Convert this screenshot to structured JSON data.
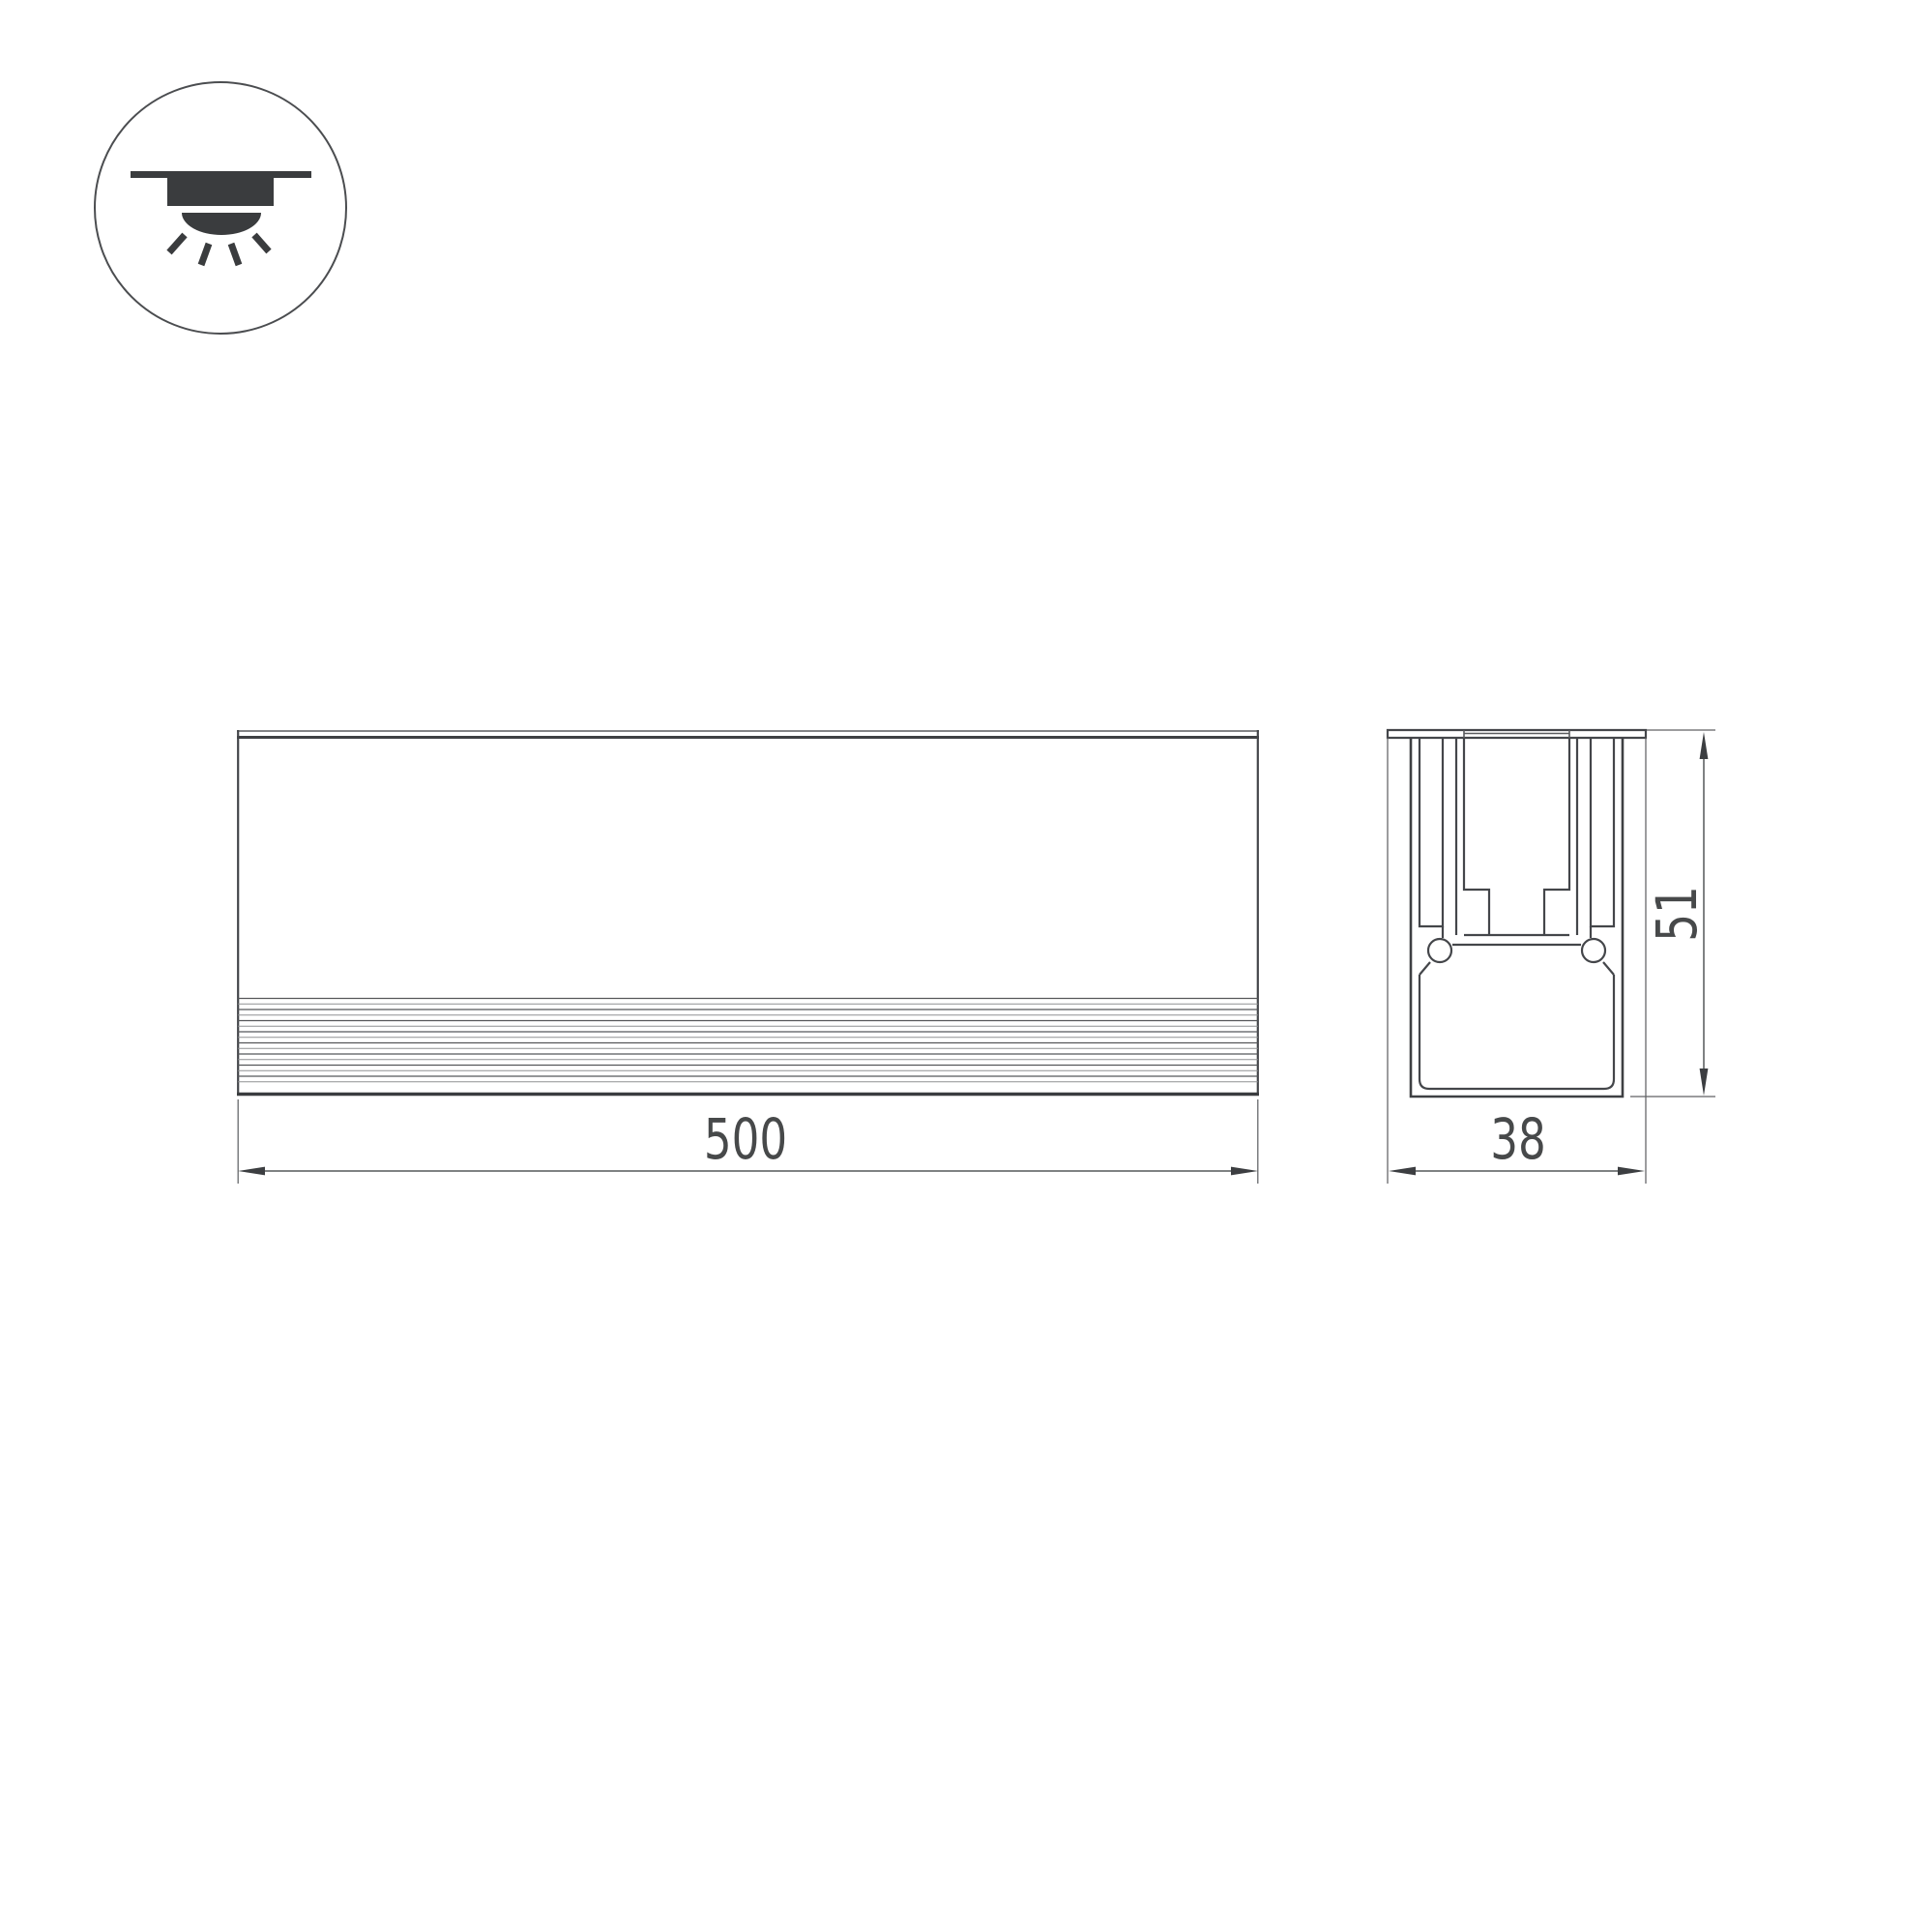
{
  "drawing": {
    "kind": "technical-drawing",
    "icon": {
      "name": "recessed-ceiling-downlight-icon",
      "parts": [
        "ceiling-line",
        "recessed-fixture-body",
        "light-dome",
        "light-rays"
      ]
    },
    "front_view": {
      "length_dimension": "500",
      "stripe_count": 16
    },
    "section_view": {
      "width_dimension": "38",
      "height_dimension": "51"
    }
  },
  "colors": {
    "background": "#ffffff",
    "main_line": "#3e4043",
    "thin_line": "#8f9193",
    "dimension_line": "#55585a",
    "dimension_text": "#47494a",
    "icon": "#3a3c3e",
    "icon_circle_outline": "#4b4d50"
  }
}
